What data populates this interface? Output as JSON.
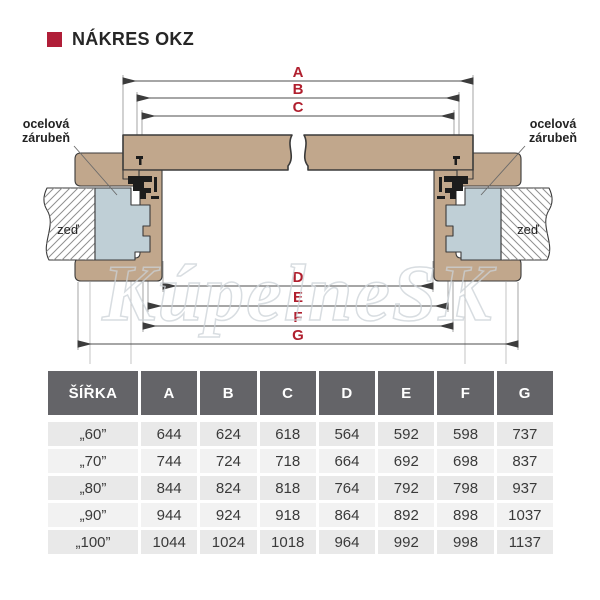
{
  "header": {
    "title": "NÁKRES OKZ",
    "bullet_color": "#b01e38"
  },
  "diagram": {
    "watermark": "KúpelneSK",
    "frame_label_lines": [
      "ocelová",
      "zárubeň"
    ],
    "wall_label": "zeď",
    "dims": {
      "A": "A",
      "B": "B",
      "C": "C",
      "D": "D",
      "E": "E",
      "F": "F",
      "G": "G"
    },
    "colors": {
      "wood": "#c1a78c",
      "steel_frame": "#bfcfd6",
      "dimension_label": "#b01f2e",
      "hatch_line": "#8f8f8f"
    }
  },
  "table": {
    "headers": [
      "ŠÍŘKA",
      "A",
      "B",
      "C",
      "D",
      "E",
      "F",
      "G"
    ],
    "rows": [
      {
        "label": "„60”",
        "values": [
          "644",
          "624",
          "618",
          "564",
          "592",
          "598",
          "737"
        ]
      },
      {
        "label": "„70”",
        "values": [
          "744",
          "724",
          "718",
          "664",
          "692",
          "698",
          "837"
        ]
      },
      {
        "label": "„80”",
        "values": [
          "844",
          "824",
          "818",
          "764",
          "792",
          "798",
          "937"
        ]
      },
      {
        "label": "„90”",
        "values": [
          "944",
          "924",
          "918",
          "864",
          "892",
          "898",
          "1037"
        ]
      },
      {
        "label": "„100”",
        "values": [
          "1044",
          "1024",
          "1018",
          "964",
          "992",
          "998",
          "1137"
        ]
      }
    ]
  }
}
